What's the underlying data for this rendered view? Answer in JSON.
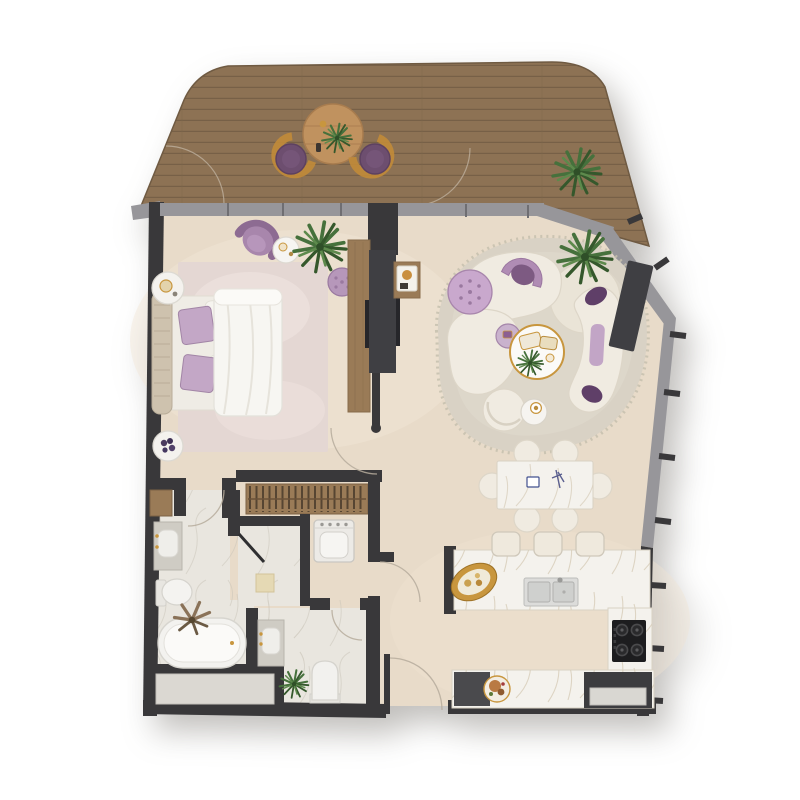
{
  "meta": {
    "kind": "apartment-floor-plan",
    "visible_text": "none"
  },
  "colors": {
    "wall": "#39383a",
    "window": "#97969a",
    "window_joint": "#6f6e72",
    "deck": "#8d7254",
    "deck_line": "#776047",
    "deck_table_wood": "#c0925f",
    "floor": "#e8dbc9",
    "floor_light": "#f1e7d8",
    "marble_floor": "#e9e6df",
    "counter": "#f4f2ed",
    "rug_bedroom": "#e4d7d3",
    "rug_living": "#d9d2c5",
    "cream": "#f0ebe1",
    "fixture": "#f4f3f0",
    "purple": "#9d7aa0",
    "purple_light": "#c2a5c6",
    "purple_dark": "#6b4b70",
    "gold": "#c8963e",
    "panel": "#3f3f43",
    "console_wood": "#9a7b57",
    "plant_green": "#46713c",
    "plant_green_dark": "#35582c",
    "plant_green_light": "#5d8a4c",
    "cooktop_black": "#1d1d1f"
  },
  "rooms": {
    "terrace": {
      "floor": "wood-deck",
      "furniture": [
        "round-bistro-table",
        "wicker-chair-left",
        "wicker-chair-right",
        "potted-plant"
      ]
    },
    "bedroom": {
      "floor": "beige-screed",
      "furniture": [
        "double-bed",
        "headboard",
        "area-rug",
        "nightstand-top",
        "nightstand-bottom",
        "accent-armchair",
        "side-table",
        "potted-plant",
        "pouf",
        "tv-console",
        "door-swing"
      ]
    },
    "living_room": {
      "floor": "beige-screed",
      "furniture": [
        "organic-rug",
        "curved-sofa-upper",
        "curved-sofa-lower",
        "chaise",
        "arch-lounge-chair",
        "tufted-pouf",
        "round-ottoman",
        "coffee-table",
        "side-table",
        "lounge-chair",
        "cup-table",
        "potted-plant",
        "wall-tv-panel"
      ]
    },
    "dining": {
      "furniture": [
        "marble-dining-table",
        "dining-chairs-x6"
      ]
    },
    "kitchen": {
      "furniture": [
        "island-counter",
        "gold-tray",
        "double-sink",
        "bar-stools-x3",
        "cooktop-4-burner",
        "tall-counter",
        "base-cabinet",
        "serving-plate",
        "fridge-unit"
      ]
    },
    "bathroom": {
      "floor": "marble",
      "furniture": [
        "vanity-basin",
        "toilet",
        "freestanding-bathtub",
        "dried-plant",
        "storage-niche"
      ]
    },
    "shower_room": {
      "furniture": [
        "glass-door",
        "bench-mat"
      ]
    },
    "utility": {
      "furniture": [
        "washing-machine",
        "wardrobe-hanging-rail"
      ]
    },
    "wc": {
      "floor": "marble",
      "furniture": [
        "vanity-basin",
        "toilet",
        "potted-plant"
      ]
    },
    "entry": {
      "furniture": [
        "entry-door-swing"
      ]
    }
  }
}
